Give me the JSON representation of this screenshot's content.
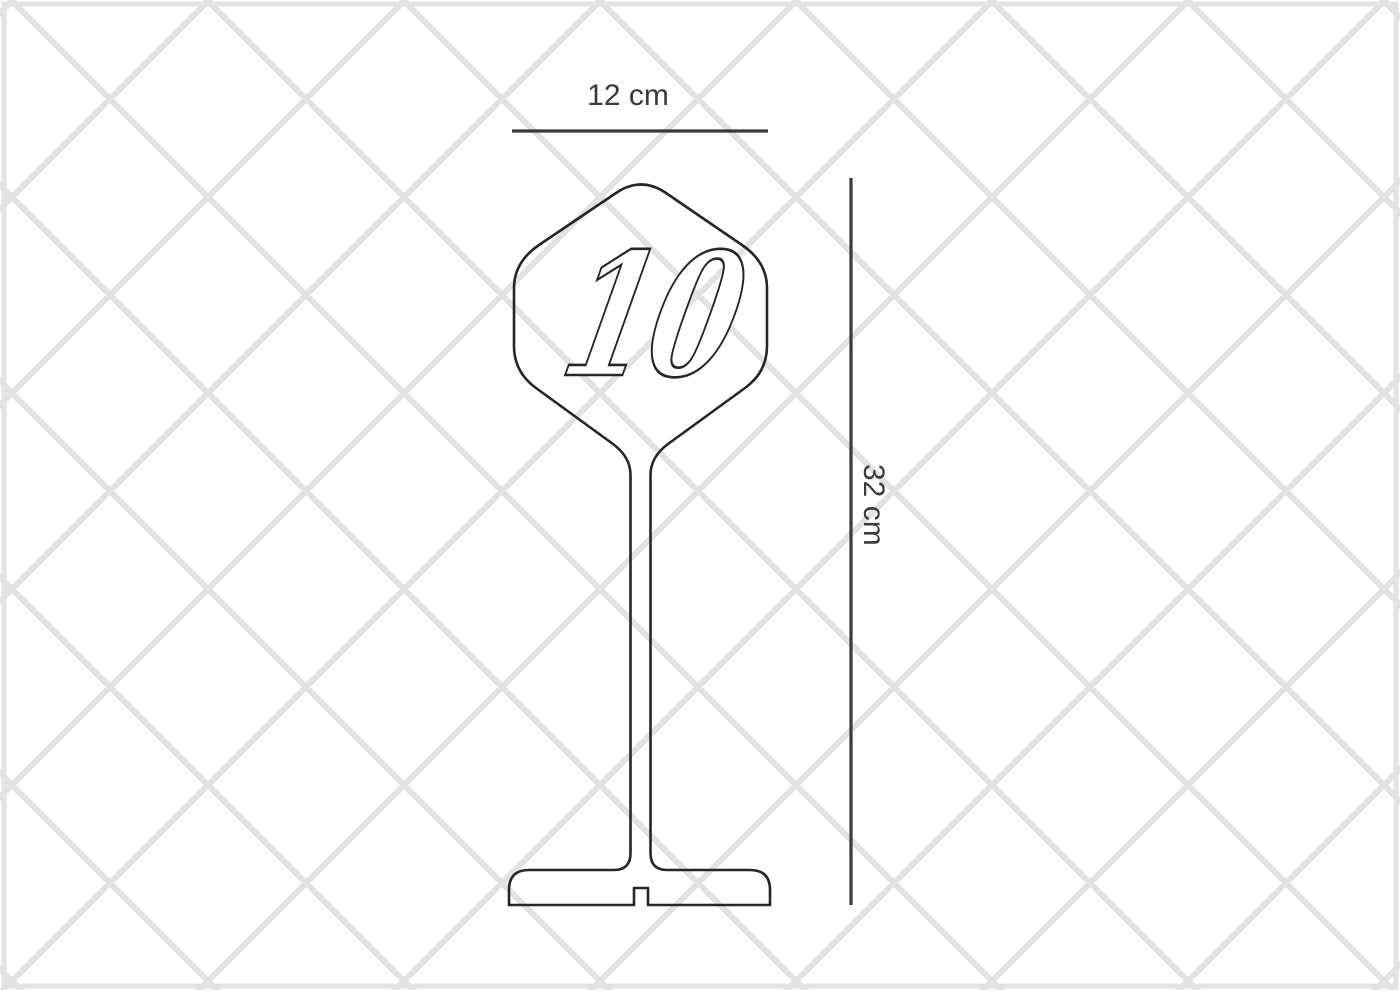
{
  "title": "Table number stand dimension drawing",
  "stand": {
    "number": "10"
  },
  "dimensions": {
    "width_label": "12 cm",
    "height_label": "32 cm"
  },
  "colors": {
    "outline": "#262626",
    "dimension_ink": "#3a3a3a",
    "pattern_line": "#e2e2e2",
    "border": "#e3e3e3",
    "glyph_fill": "#ffffff",
    "background": "#ffffff"
  }
}
